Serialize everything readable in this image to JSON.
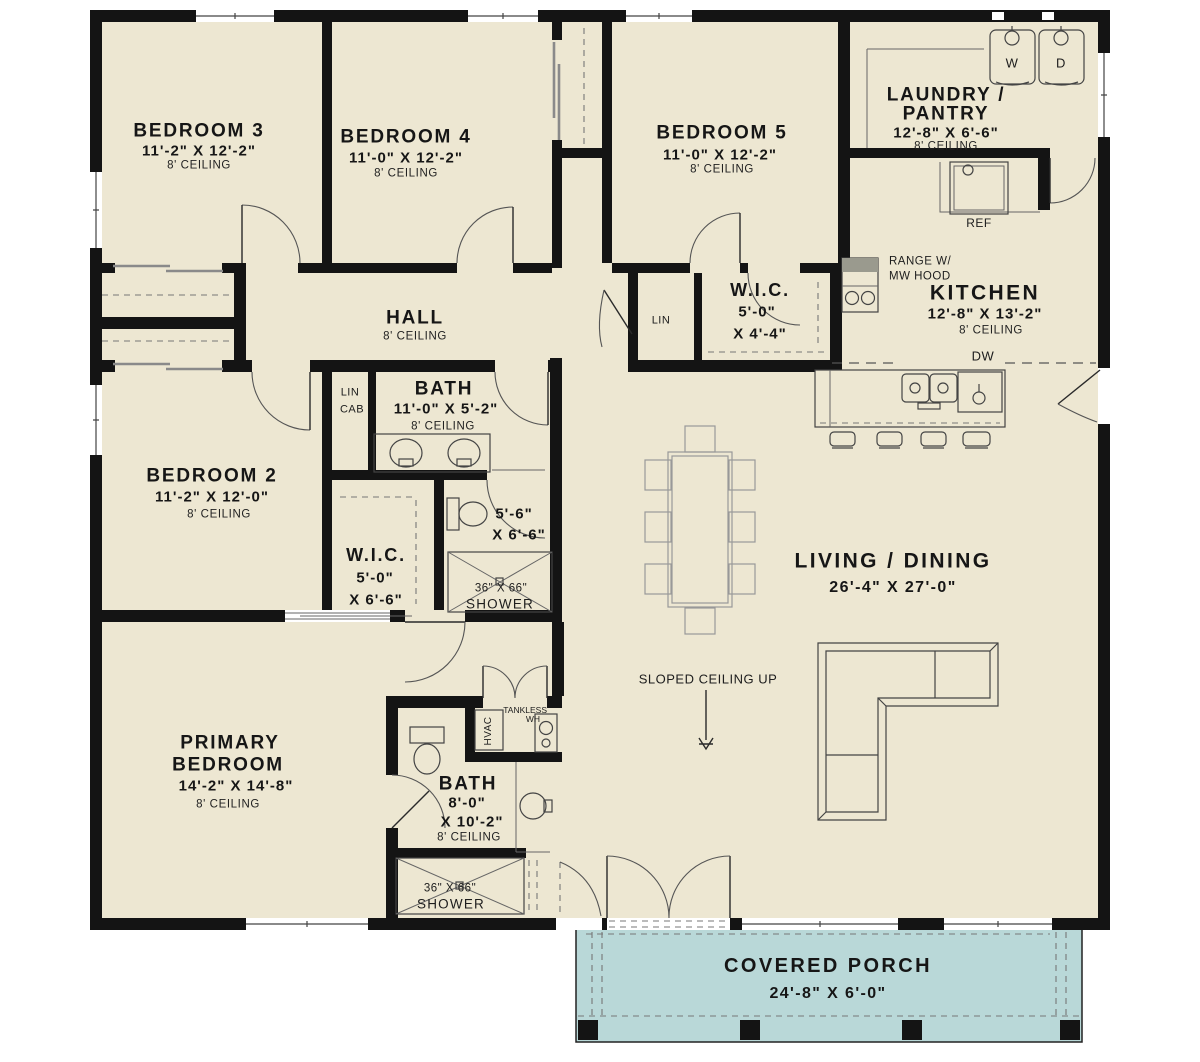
{
  "plan": {
    "rooms": {
      "bedroom3": {
        "name": "BEDROOM 3",
        "dims": "11'-2\" X 12'-2\"",
        "ceiling": "8' CEILING"
      },
      "bedroom4": {
        "name": "BEDROOM 4",
        "dims": "11'-0\" X 12'-2\"",
        "ceiling": "8' CEILING"
      },
      "bedroom5": {
        "name": "BEDROOM 5",
        "dims": "11'-0\" X 12'-2\"",
        "ceiling": "8' CEILING"
      },
      "laundry": {
        "name_line1": "LAUNDRY /",
        "name_line2": "PANTRY",
        "dims": "12'-8\" X 6'-6\"",
        "ceiling": "8' CEILING"
      },
      "kitchen": {
        "name": "KITCHEN",
        "dims": "12'-8\" X 13'-2\"",
        "ceiling": "8' CEILING"
      },
      "wic_hall": {
        "name": "W.I.C.",
        "dims_line1": "5'-0\"",
        "dims_line2": "X 4'-4\""
      },
      "hall": {
        "name": "HALL",
        "ceiling": "8' CEILING"
      },
      "bath_hall": {
        "name": "BATH",
        "dims": "11'-0\" X 5'-2\"",
        "ceiling": "8' CEILING"
      },
      "bedroom2": {
        "name": "BEDROOM 2",
        "dims": "11'-2\" X 12'-0\"",
        "ceiling": "8' CEILING"
      },
      "wic_bedroom2": {
        "name": "W.I.C.",
        "dims_line1": "5'-0\"",
        "dims_line2": "X 6'-6\""
      },
      "water_closet": {
        "dims_line1": "5'-6\"",
        "dims_line2": "X 6'-6\""
      },
      "living_dining": {
        "name": "LIVING / DINING",
        "dims": "26'-4\" X 27'-0\""
      },
      "primary_bedroom": {
        "name_line1": "PRIMARY",
        "name_line2": "BEDROOM",
        "dims": "14'-2\" X 14'-8\"",
        "ceiling": "8' CEILING"
      },
      "primary_bath": {
        "name": "BATH",
        "dims_line1": "8'-0\"",
        "dims_line2": "X 10'-2\"",
        "ceiling": "8' CEILING"
      },
      "covered_porch": {
        "name": "COVERED PORCH",
        "dims": "24'-8\" X 6'-0\""
      }
    },
    "annotations": {
      "sloped_ceiling": "SLOPED CEILING UP",
      "range_line1": "RANGE W/",
      "range_line2": "MW HOOD",
      "ref": "REF",
      "dw": "DW",
      "washer": "W",
      "dryer": "D",
      "lin": "LIN",
      "lin_cab_line1": "LIN",
      "lin_cab_line2": "CAB",
      "hvac": "HVAC",
      "tankless_line1": "TANKLESS",
      "tankless_line2": "WH",
      "shower_size": "36\" X 66\"",
      "shower": "SHOWER"
    },
    "colors": {
      "floor": "#EDE7D2",
      "porch": "#B9D8D8",
      "wall": "#141414",
      "accent_line": "#444444"
    }
  }
}
